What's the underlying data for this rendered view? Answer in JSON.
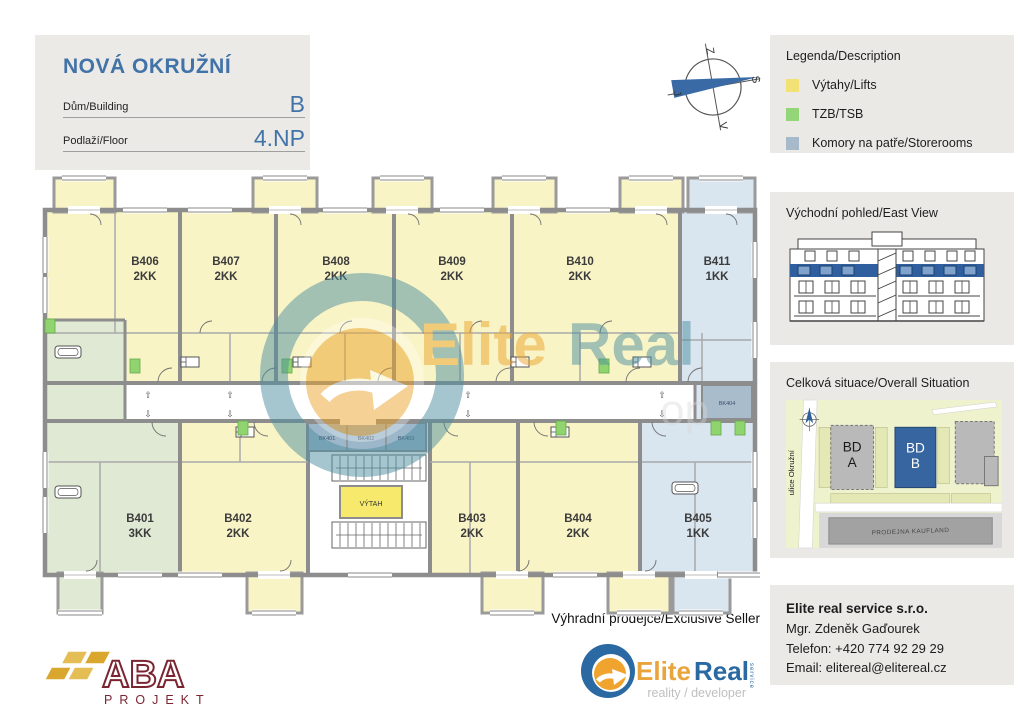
{
  "title_block": {
    "project": "NOVÁ OKRUŽNÍ",
    "building_label": "Dům/Building",
    "building_value": "B",
    "floor_label": "Podlaží/Floor",
    "floor_value": "4.NP"
  },
  "compass": {
    "top": "Z",
    "right": "S",
    "bottom": "V",
    "left": "J"
  },
  "sidebar": {
    "legend": {
      "title": "Legenda/Description",
      "items": [
        {
          "label": "Výtahy/Lifts",
          "color": "#f2e175"
        },
        {
          "label": "TZB/TSB",
          "color": "#92d677"
        },
        {
          "label": "Komory na patře/Storerooms",
          "color": "#a7bac9"
        }
      ]
    },
    "east_view_title": "Východní pohled/East View",
    "situation": {
      "title": "Celková situace/Overall Situation",
      "street_label": "ulice Okružní",
      "building_a_line1": "BD",
      "building_a_line2": "A",
      "building_b_line1": "BD",
      "building_b_line2": "B",
      "store_label": "PRODEJNA KAUFLAND"
    },
    "contact": {
      "company": "Elite real service s.r.o.",
      "agent": "Mgr. Zdeněk Gaďourek",
      "phone": "Telefon: +420 774 92 29 29",
      "email": "Email: elitereal@elitereal.cz"
    }
  },
  "seller": {
    "heading": "Výhradní prodejce/Exclusive Seller"
  },
  "brands": {
    "elitereal": {
      "part1": "Elite",
      "part2": "Real",
      "service": "service",
      "tagline": "reality / developer"
    },
    "aba": {
      "name": "ABA",
      "sub": "PROJEKT"
    }
  },
  "watermark": {
    "part1": "Elite",
    "part2": "Real"
  },
  "floorplan": {
    "lift_label": "VÝTAH",
    "arrow_up": "⇧",
    "arrow_down": "⇩",
    "units": [
      {
        "id": "B406",
        "type": "2KK"
      },
      {
        "id": "B407",
        "type": "2KK"
      },
      {
        "id": "B408",
        "type": "2KK"
      },
      {
        "id": "B409",
        "type": "2KK"
      },
      {
        "id": "B410",
        "type": "2KK"
      },
      {
        "id": "B411",
        "type": "1KK"
      },
      {
        "id": "B401",
        "type": "3KK"
      },
      {
        "id": "B402",
        "type": "2KK"
      },
      {
        "id": "B403",
        "type": "2KK"
      },
      {
        "id": "B404",
        "type": "2KK"
      },
      {
        "id": "B405",
        "type": "1KK"
      }
    ],
    "storerooms": [
      {
        "id": "BK401"
      },
      {
        "id": "BK402"
      },
      {
        "id": "BK403"
      },
      {
        "id": "BK404"
      }
    ]
  },
  "palette": {
    "unit_yellow": "#f9f4c6",
    "unit_green": "#dfe9d4",
    "unit_blue": "#d9e5ef",
    "storeroom_blue": "#9db7ca",
    "storeroom_blue2": "#a9bccc",
    "tzb_green": "#8fd46f",
    "lift_yellow": "#f6e96b",
    "wall_gray": "#8d8d8d",
    "accent_blue": "#4273a8",
    "highlight_band": "#2f5f9e"
  }
}
